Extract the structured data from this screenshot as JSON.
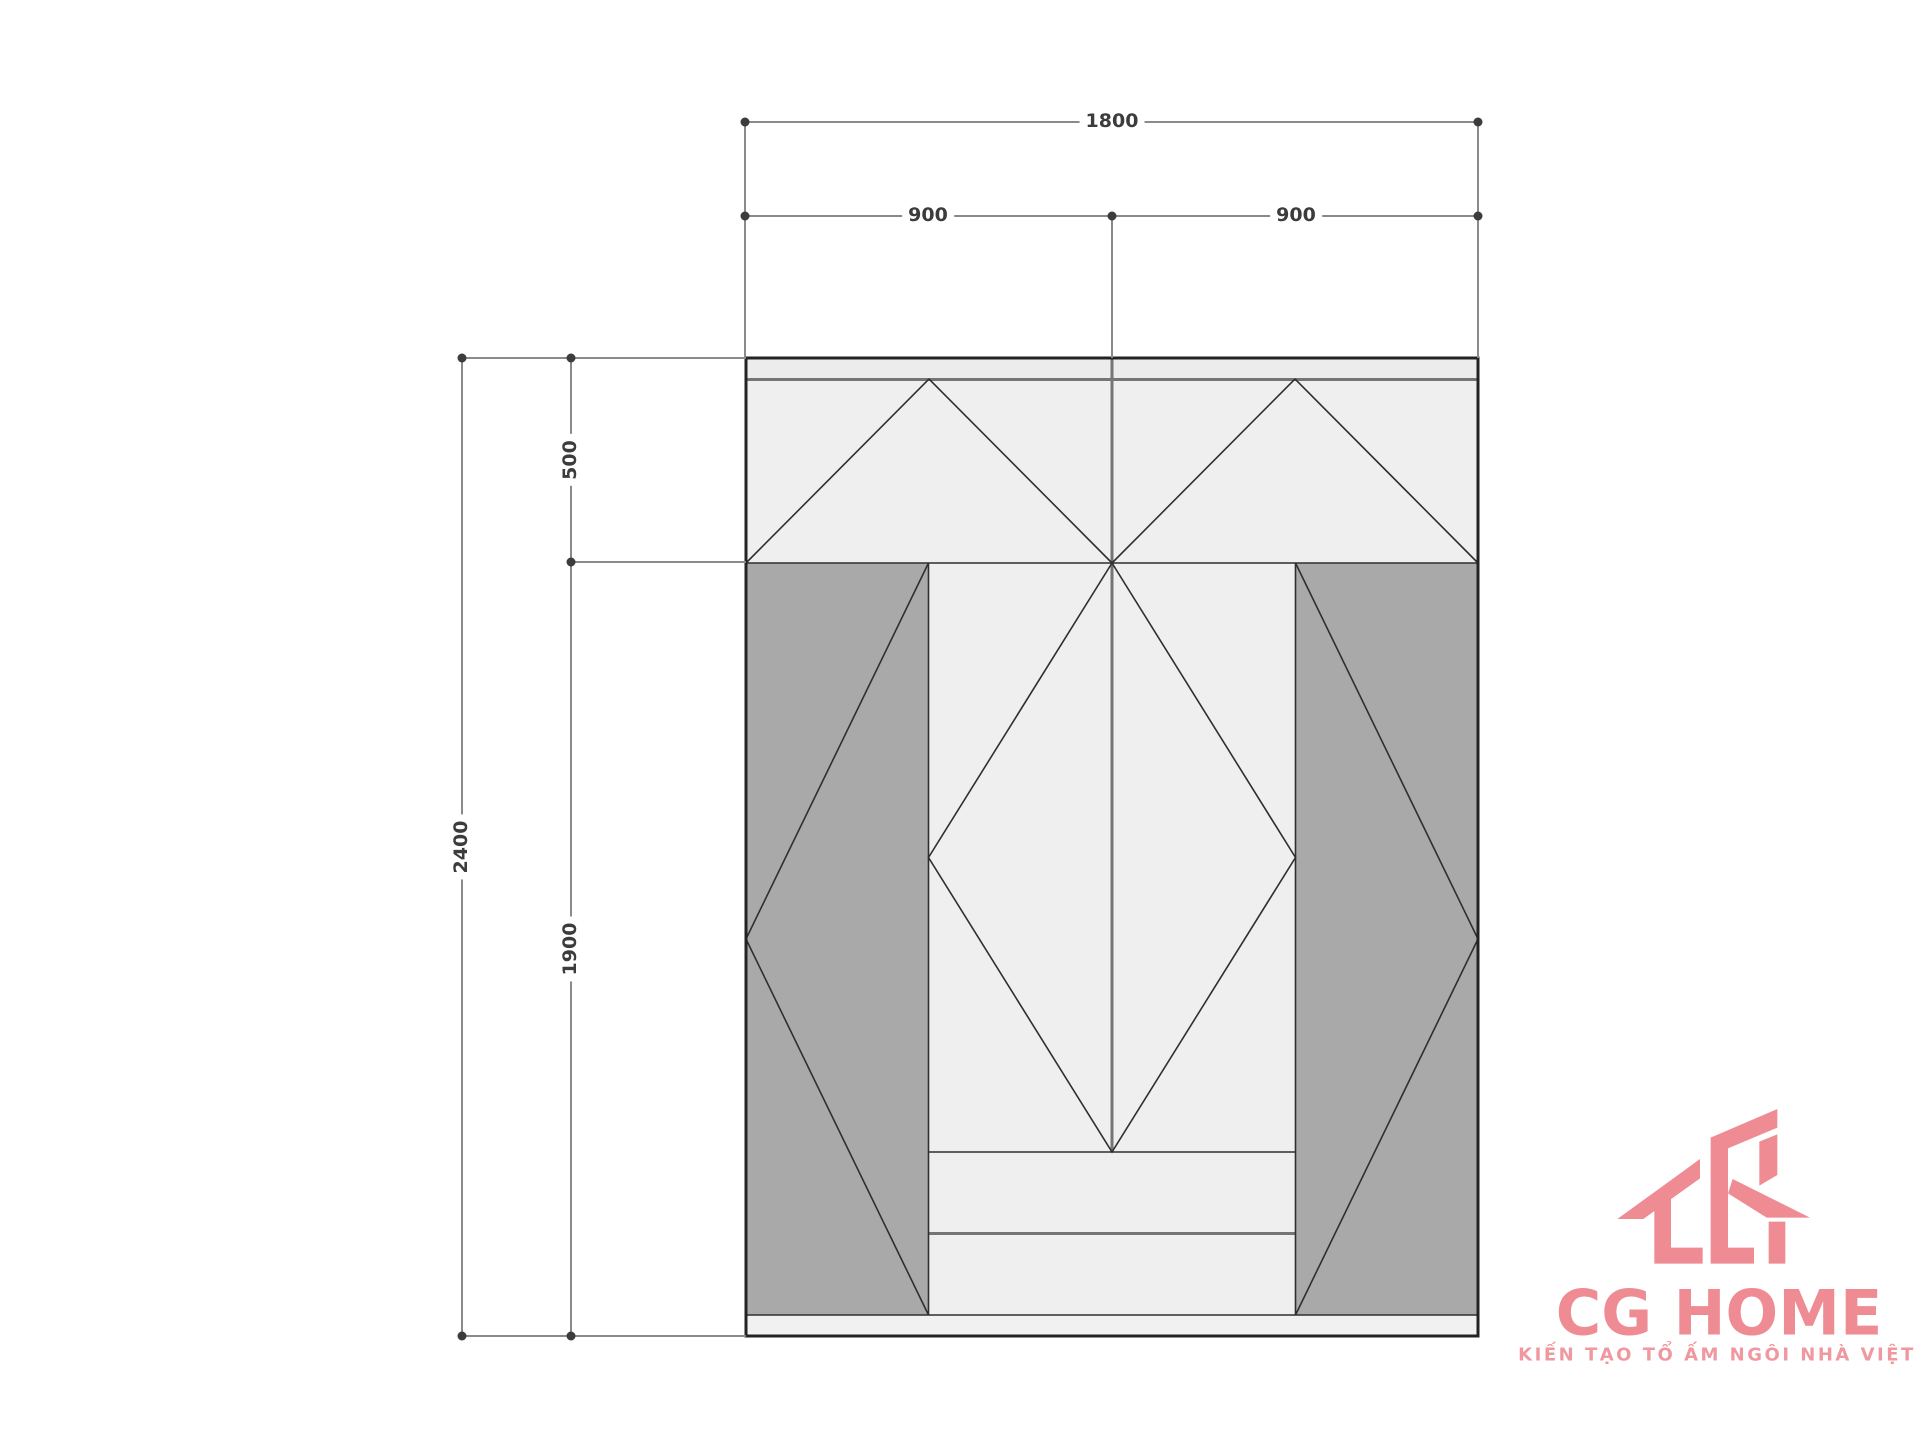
{
  "colors": {
    "page_bg": "#ffffff",
    "line_dark": "#232323",
    "line_seam": "#2f2f2f",
    "line_gray": "#757575",
    "line_medium": "#8a8a8a",
    "panel_dark": "#a9a9a9",
    "section_light": "#efefef",
    "strip_top": "#ececec",
    "strip_bottom": "#f1f1f1",
    "dim_text": "#3c3c3c",
    "brand_pink": "#ee8b93",
    "brand_pink_light": "#f0989f"
  },
  "dimensions": {
    "width_total": "1800",
    "width_left": "900",
    "width_right": "900",
    "height_total": "2400",
    "height_top_section": "500",
    "height_body_section": "1900"
  },
  "logo": {
    "name": "CG HOME",
    "tagline": "KIẾN TẠO TỔ ẤM NGÔI NHÀ VIỆT"
  }
}
